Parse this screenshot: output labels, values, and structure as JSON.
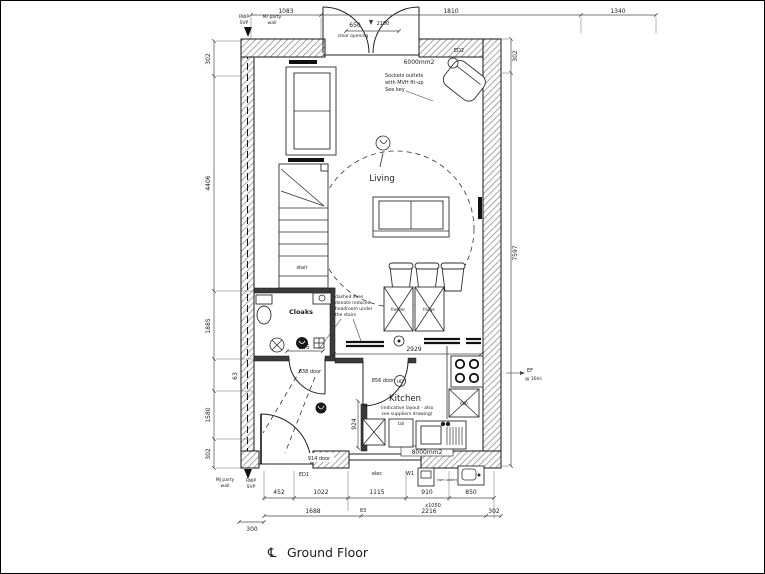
{
  "drawing": {
    "title": "Ground Floor",
    "centerline_symbol": "℄",
    "rooms": {
      "living": "Living",
      "kitchen": "Kitchen",
      "cloaks": "Cloaks",
      "stair": "stair"
    },
    "doors": {
      "ed1": "ED1",
      "ed2": "ED2",
      "door_838": "838 door",
      "door_856": "856 door",
      "door_914": "914 door"
    },
    "windows": {
      "top_vent": "6000mm2",
      "bottom_vent": "8000mm2",
      "clear_opening": "clear opening",
      "opening_width": "650",
      "head_height": "2100"
    },
    "notes": {
      "sockets": [
        "Sockets outlets",
        "with MVH fit-up",
        "See key"
      ],
      "kitchen_note": [
        "(indicative layout - also",
        "see suppliers drawing)"
      ],
      "turning": [
        "dashed lines",
        "denote reduced",
        "headroom under",
        "the stairs"
      ],
      "extract_fan": [
        "EF",
        "@ 30l/s"
      ],
      "party_wall_top": [
        "M/ party",
        "wall"
      ],
      "party_wall_bottom": [
        "MJ party",
        "wall"
      ],
      "rwp_top": [
        "RWP",
        "SVP"
      ],
      "rwp_bottom": [
        "RWP",
        "SVP"
      ],
      "heat_detector": "HD",
      "wm_under": "(wm under)"
    },
    "appliances": {
      "freezer": "freezer",
      "fridge": "fridge",
      "oven": "600",
      "tall": "tall",
      "w1": "W1",
      "elec": "elec"
    },
    "dims": {
      "top": [
        "1083",
        "1810",
        "1340"
      ],
      "left": [
        "302",
        "4406",
        "1885",
        "63",
        "1580",
        "302"
      ],
      "right": [
        "302",
        "7597"
      ],
      "bottom1": [
        "452",
        "1022",
        "1115",
        "910",
        "850"
      ],
      "bottom2": [
        "1688",
        "2216",
        "302"
      ],
      "bottom3": "300",
      "cloaks_width": "945",
      "kitchen_run": "2929",
      "kitchen_depth": "924",
      "small": "83",
      "max_1050": "x1050"
    }
  }
}
